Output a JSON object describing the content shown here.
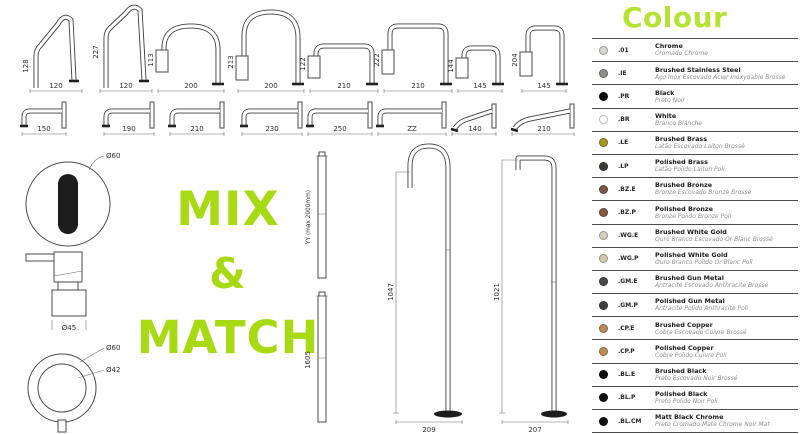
{
  "colors": {
    "title_green": "#b5e334",
    "mix_green": "#a7da12",
    "line_art": "#3e3e3e"
  },
  "mix_and_match": {
    "line1": "MIX",
    "line2": "&",
    "line3": "MATCH"
  },
  "top_row": [
    {
      "height": "128",
      "width": "120"
    },
    {
      "height": "227",
      "width": "120"
    },
    {
      "height": "113",
      "width": "200"
    },
    {
      "height": "213",
      "width": "200"
    },
    {
      "height": "122",
      "width": "210"
    },
    {
      "height": "222",
      "width": "210"
    },
    {
      "height": "144",
      "width": "145"
    },
    {
      "height": "204",
      "width": "145"
    }
  ],
  "wall_row": [
    "150",
    "190",
    "210",
    "230",
    "250",
    "ZZ",
    "140",
    "210"
  ],
  "left_items": {
    "sensor_diameter": "Ø60",
    "handle_diameter": "Ø45",
    "ring_outer_diameter": "Ø60",
    "ring_inner_diameter": "Ø42"
  },
  "risers": {
    "custom_label": "YY (max 2000mm)",
    "fixed_height": "1605"
  },
  "freestanding": [
    {
      "height": "1047",
      "base_width": "209"
    },
    {
      "height": "1021",
      "base_width": "207"
    }
  ],
  "colour_panel": {
    "title": "Colour",
    "finishes": [
      {
        "code": ".01",
        "name": "Chrome",
        "subtitle": "Cromado Chrome",
        "swatch": "#d6d6d2"
      },
      {
        "code": ".IE",
        "name": "Brushed Stainless Steel",
        "subtitle": "Aço Inox Escovado Acier Inoxydable Brossé",
        "swatch": "#8e8e8a"
      },
      {
        "code": ".PR",
        "name": "Black",
        "subtitle": "Preto Noir",
        "swatch": "#0a0a0a"
      },
      {
        "code": ".BR",
        "name": "White",
        "subtitle": "Branco Blanche",
        "swatch": "#ffffff"
      },
      {
        "code": ".LE",
        "name": "Brushed Brass",
        "subtitle": "Latão Escovado Laiton Brossé",
        "swatch": "#a8951e"
      },
      {
        "code": ".LP",
        "name": "Polished Brass",
        "subtitle": "Latão Polido Laiton Poli",
        "swatch": "#3b3a36"
      },
      {
        "code": ".BZ.E",
        "name": "Brushed Bronze",
        "subtitle": "Bronze Escovado Bronze Brossé",
        "swatch": "#7c5847"
      },
      {
        "code": ".BZ.P",
        "name": "Polished Bronze",
        "subtitle": "Bronze Polido Bronze Poli",
        "swatch": "#855a44"
      },
      {
        "code": ".WG.E",
        "name": "Brushed White Gold",
        "subtitle": "Ouro Branco Escovado Or Blanc Brossé",
        "swatch": "#d5cec0"
      },
      {
        "code": ".WG.P",
        "name": "Polished White Gold",
        "subtitle": "Ouro Branco Polido Or Blanc Poli",
        "swatch": "#d3c9b2"
      },
      {
        "code": ".GM.E",
        "name": "Brushed Gun Metal",
        "subtitle": "Antracite Escovado Anthracite Brossé",
        "swatch": "#4a4a48"
      },
      {
        "code": ".GM.P",
        "name": "Polished Gun Metal",
        "subtitle": "Antracite Polido Anthracite Poli",
        "swatch": "#404044"
      },
      {
        "code": ".CP.E",
        "name": "Brushed Copper",
        "subtitle": "Cobre Escovado Cuivre Brossé",
        "swatch": "#b98a5a"
      },
      {
        "code": ".CP.P",
        "name": "Polished Copper",
        "subtitle": "Cobre Polido Cuivre Poli",
        "swatch": "#bd8c55"
      },
      {
        "code": ".BL.E",
        "name": "Brushed Black",
        "subtitle": "Preto Escovado Noir Brossé",
        "swatch": "#0d0d0d"
      },
      {
        "code": ".BL.P",
        "name": "Polished Black",
        "subtitle": "Preto Polido Noir Poli",
        "swatch": "#0c0c0c"
      },
      {
        "code": ".BL.CM",
        "name": "Matt Black Chrome",
        "subtitle": "Preto Cromado Mate Chrome Noir Mat",
        "swatch": "#0e0e0e"
      }
    ]
  }
}
